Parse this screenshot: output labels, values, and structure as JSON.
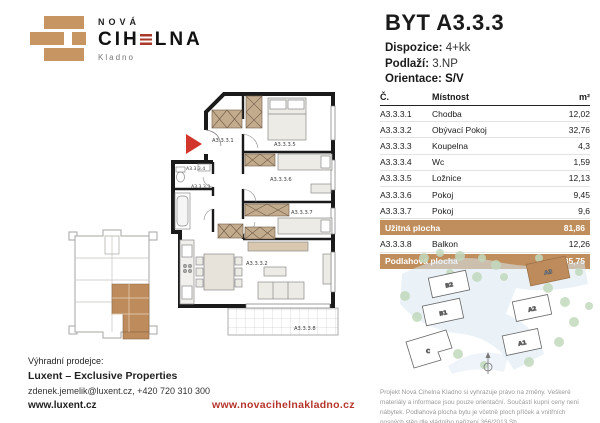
{
  "brand": {
    "name_top": "NOVÁ",
    "name_left": "CIH",
    "name_right": "LNA",
    "city": "Kladno"
  },
  "unit": {
    "title": "BYT A3.3.3",
    "details": [
      {
        "label": "Dispozice:",
        "value": "4+kk"
      },
      {
        "label": "Podlaží:",
        "value": "3.NP"
      },
      {
        "label": "Orientace:",
        "value": "S/V"
      }
    ]
  },
  "table": {
    "headers": {
      "no": "Č.",
      "room": "Místnost",
      "area": "m²"
    },
    "rows": [
      {
        "no": "A3.3.3.1",
        "room": "Chodba",
        "area": "12,02"
      },
      {
        "no": "A3.3.3.2",
        "room": "Obývací Pokoj",
        "area": "32,76"
      },
      {
        "no": "A3.3.3.3",
        "room": "Koupelna",
        "area": "4,3"
      },
      {
        "no": "A3.3.3.4",
        "room": "Wc",
        "area": "1,59"
      },
      {
        "no": "A3.3.3.5",
        "room": "Ložnice",
        "area": "12,13"
      },
      {
        "no": "A3.3.3.6",
        "room": "Pokoj",
        "area": "9,45"
      },
      {
        "no": "A3.3.3.7",
        "room": "Pokoj",
        "area": "9,6"
      }
    ],
    "uzitna": {
      "label": "Užitná plocha",
      "value": "81,86"
    },
    "balkon": {
      "no": "A3.3.3.8",
      "room": "Balkon",
      "area": "12,26"
    },
    "podlahova": {
      "label": "Podlahová plocha",
      "value": "85,75"
    }
  },
  "floorplan": {
    "labels": [
      "A3.3.3.1",
      "A3.3.3.5",
      "A3.3.3.4",
      "A3.3.3.3",
      "A3.3.3.6",
      "A3.3.3.7",
      "A3.3.3.2",
      "A3.3.3.8"
    ]
  },
  "siteplan": {
    "buildings": [
      "B2",
      "B1",
      "A2",
      "A1",
      "C"
    ],
    "highlighted": "A3"
  },
  "seller": {
    "heading": "Výhradní prodejce:",
    "name": "Luxent – Exclusive Properties",
    "contact": "zdenek.jemelik@luxent.cz, +420 720 310 300",
    "web": "www.luxent.cz"
  },
  "project_web": "www.novacihelnakladno.cz",
  "disclaimer": "Projekt Nová Cihelna Kladno si vyhrazuje právo na změny. Veškeré materiály a informace jsou pouze orientační. Součástí kupní ceny není nábytek. Podlahová plocha bytu je včetně ploch příček a vnitřních nosných stěn dle vládního nařízení 366/2013 Sb.",
  "colors": {
    "accent_tan": "#bf8e5c",
    "brick_red": "#a8392b",
    "link_red": "#b5342b"
  }
}
